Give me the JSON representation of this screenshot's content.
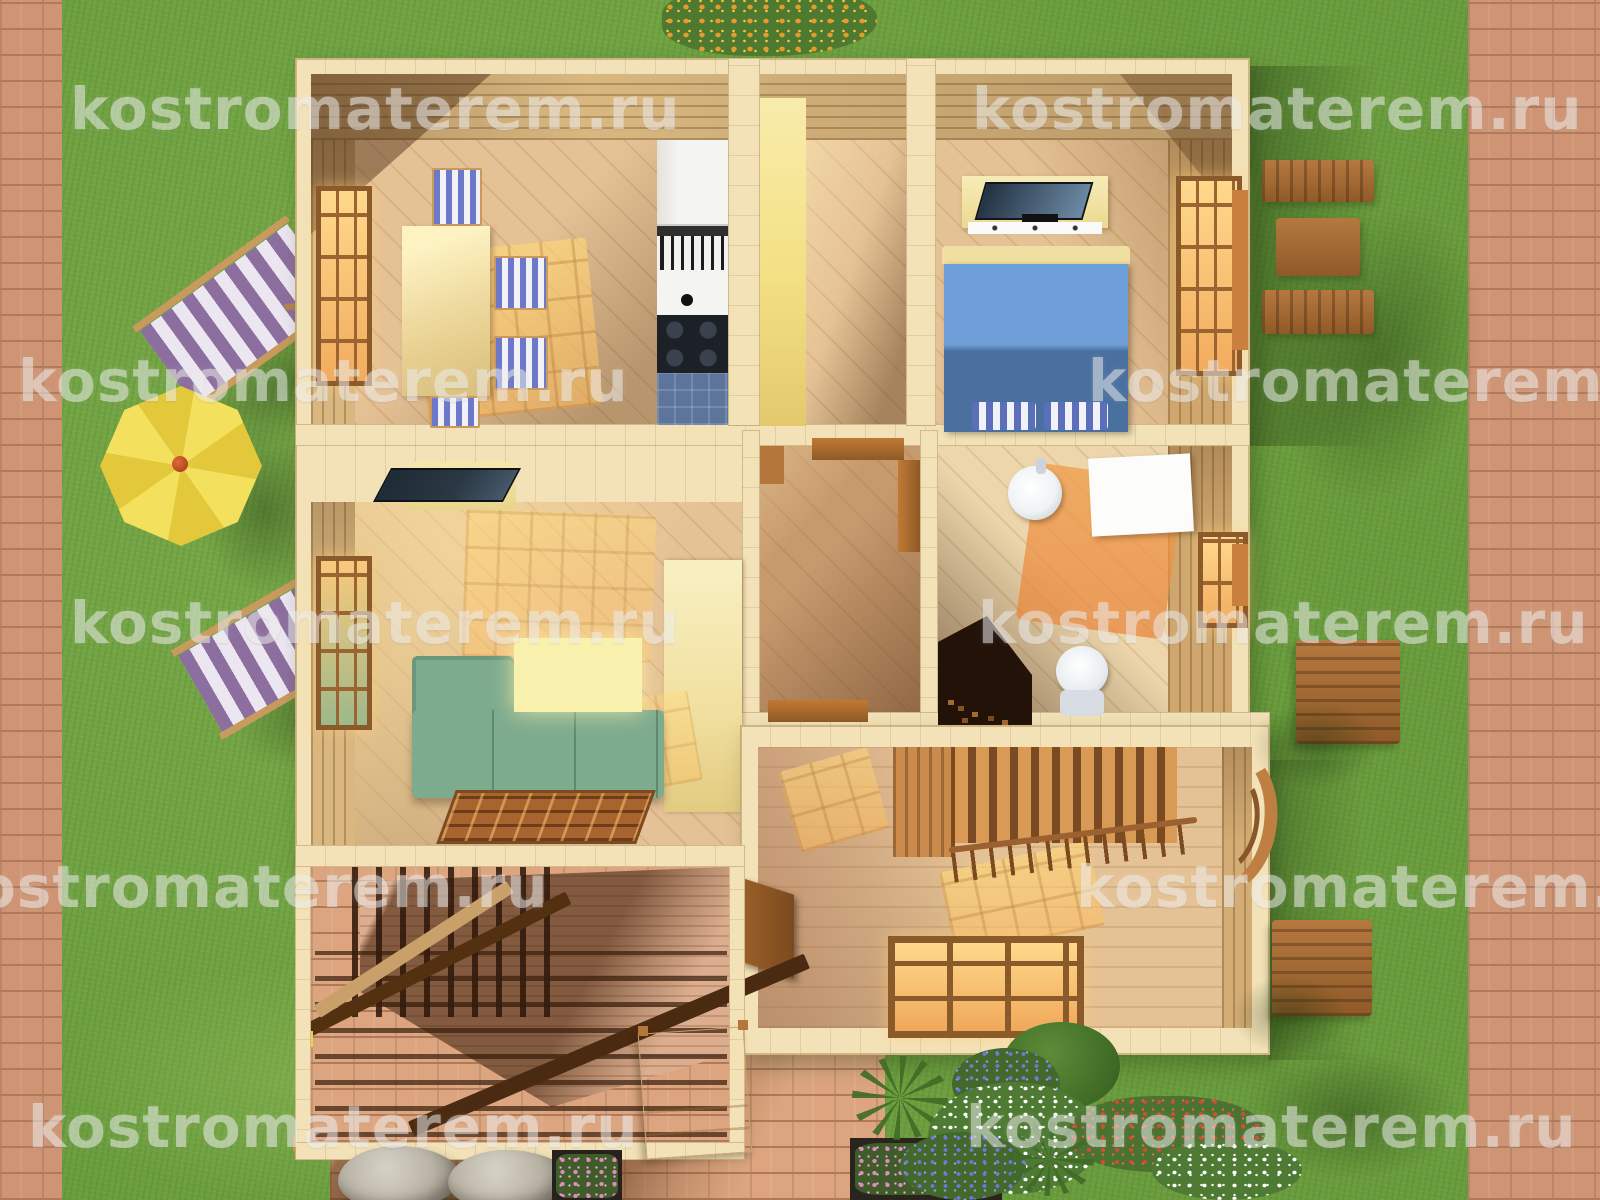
{
  "scene": {
    "type": "3d-top-down-floor-plan-render",
    "description": "Aerial 3D render of a wooden house first floor with garden"
  },
  "watermark": {
    "text": "kostromaterem.ru"
  },
  "colors": {
    "grass": "#6FA242",
    "grass-dark": "#48702C",
    "brick": "#CE9474",
    "brick-mortar": "#B07A5A",
    "wall-wood": "#F3E2B8",
    "wall-face": "#D9B77F",
    "floor-wood": "#E5C295",
    "floor-dark": "#C79A6E",
    "sun": "#FFD98C",
    "yellow-wall": "#F3E083",
    "sofa": "#7DAB8E",
    "ottoman": "#F9F2AE",
    "rug": "#A8642E",
    "bed-light": "#6F9FD8",
    "bed-dark": "#49709F",
    "pillow": "#5B6FBB",
    "tv-screen": "#2B3945",
    "appliance-white": "#F4F4F2",
    "counter-blue": "#5D749C",
    "stove-black": "#1C2128",
    "fixture-white": "#EFF3F4",
    "sauna-stove": "#221208",
    "window-frame": "#8A5A2B",
    "window-glow": "#FFD98C",
    "deck-chair": "#8D6F9F",
    "parasol": "#F0DC4E",
    "bench-wood": "#A06A38",
    "stone": "#B8B2A4",
    "terrace-beam": "#53300F",
    "deck-wood": "#DCAE8F",
    "watermark-color": "#EDEDED"
  }
}
